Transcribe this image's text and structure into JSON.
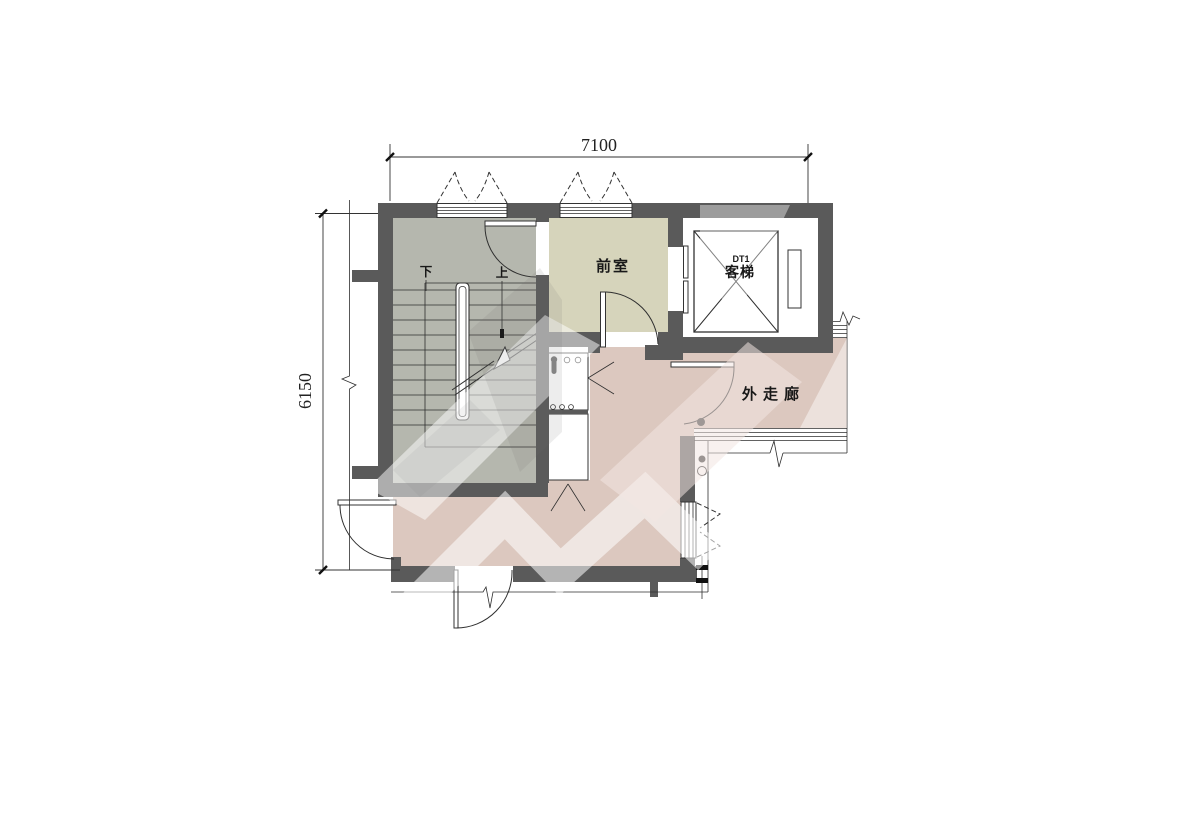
{
  "plan": {
    "dim_top": "7100",
    "dim_left": "6150",
    "rooms": {
      "vestibule": "前室",
      "corridor": "外 走 廊",
      "elevator_code": "DT1",
      "elevator_name": "客梯",
      "stair_down": "下",
      "stair_up": "上"
    },
    "colors": {
      "wall": "#5a5a5a",
      "stair_fill": "#b5b7ae",
      "vestibule_fill": "#d6d4bb",
      "corridor_fill": "#dcc8bf",
      "line": "#2f2f2f"
    }
  }
}
